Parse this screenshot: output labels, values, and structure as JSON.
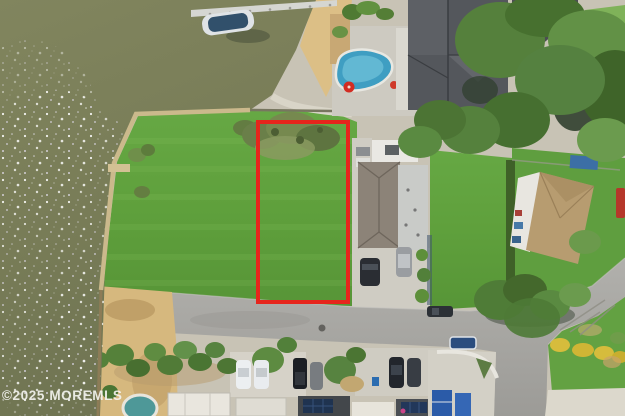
{
  "watermark": {
    "text": "©2025 MOREMLS",
    "color": "#f3f3ee"
  },
  "listing_photo": {
    "kind": "aerial-drone-photo-of-waterfront-vacant-lot",
    "boundary": {
      "color": "#e6251c",
      "stroke_width": 4
    },
    "palette": {
      "water": "#7a7e59",
      "grass": "#61a23f",
      "road": "#a8a7a2",
      "sand": "#d7b97f",
      "pool": "#3f9ec2",
      "roof_dark": "#54575c",
      "roof_taupe": "#8c8378",
      "roof_tan": "#b79c70",
      "red_umbrella": "#d22c22"
    }
  }
}
